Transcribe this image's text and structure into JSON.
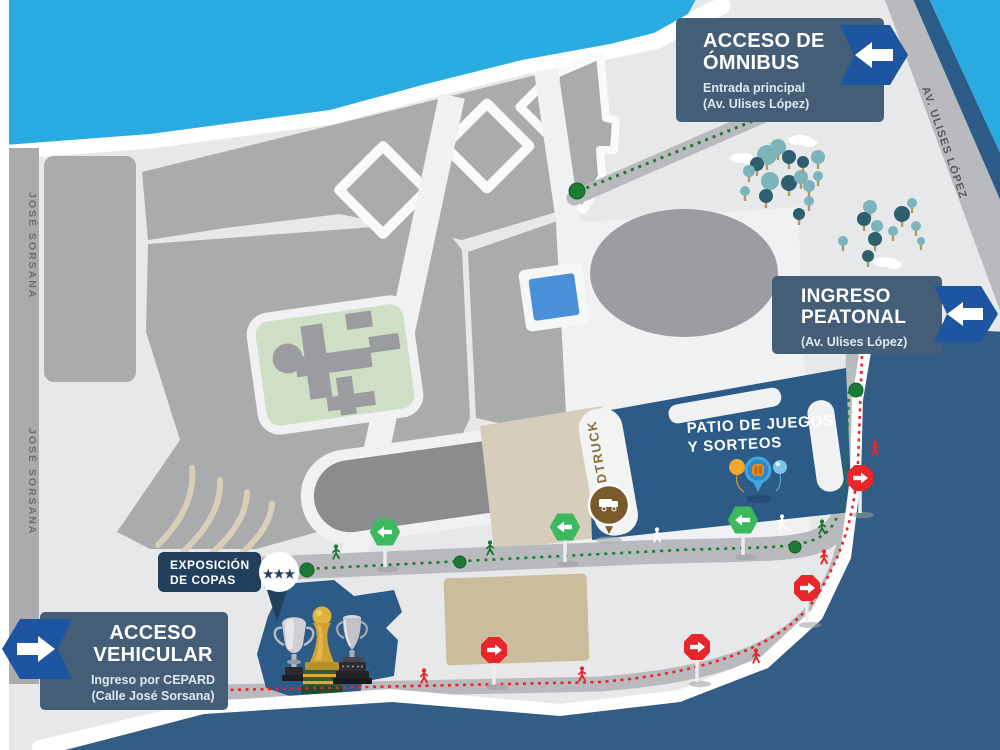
{
  "map": {
    "access_boxes": {
      "bus": {
        "title": [
          "ACCESO DE",
          "ÓMNIBUS"
        ],
        "subtitle": [
          "Entrada principal",
          "(Av. Ulises López)"
        ],
        "arrow_direction": "left"
      },
      "pedestrian": {
        "title": [
          "INGRESO",
          "PEATONAL"
        ],
        "subtitle": [
          "(Av. Ulises López)"
        ],
        "arrow_direction": "left"
      },
      "vehicular": {
        "title": [
          "ACCESO",
          "VEHICULAR"
        ],
        "subtitle": [
          "Ingreso por CEPARD",
          "(Calle José Sorsana)"
        ],
        "arrow_direction": "right"
      }
    },
    "areas": {
      "patio": [
        "PATIO DE JUEGOS",
        "Y SORTEOS"
      ],
      "foodtruck": "FOODTRUCK",
      "trophy_exhibit": [
        "EXPOSICIÓN",
        "DE COPAS"
      ],
      "trophy_stars": "★★★"
    },
    "streets": {
      "left": "JOSÉ SORSANA",
      "right": "AV. ULISES LÓPEZ"
    },
    "routes": {
      "bus": {
        "color": "#1e7a34",
        "style": "dashed"
      },
      "pedestrian": {
        "color": "#1e7a34",
        "style": "dashed"
      },
      "vehicular": {
        "color": "#e8252a",
        "style": "dashed"
      }
    },
    "icons": {
      "bus_badge": "left-arrow-icon",
      "pedestrian_badge": "left-arrow-icon",
      "vehicular_badge": "right-arrow-icon",
      "green_sign": "green-left-arrow-sign-icon",
      "red_sign": "red-right-arrow-sign-icon",
      "walking_person": "walking-person-icon",
      "tree": "tree-icon",
      "cloud": "cloud-icon",
      "balloons": "balloons-icon",
      "game_pin": "raffle-pin-icon",
      "foodtruck": "foodtruck-icon",
      "trophies": "trophy-icons",
      "stars": "three-stars-icon"
    },
    "colors": {
      "water_light": "#29abe2",
      "water_dark": "#335d85",
      "land": "#e7e8e9",
      "parcel": "#a9abad",
      "road": "#b9babd",
      "panel": "#455e77",
      "badge_blue": "#1e55a0",
      "patio_blue": "#2d5b88",
      "route_green": "#1e7a34",
      "route_red": "#e8252a",
      "sign_green": "#3cb95e",
      "green_area": "#cfdfc5",
      "sand": "#cbbd9c",
      "tree_teal": "#7cb4bc",
      "tree_dark": "#2d5f6e",
      "foodtruck_brown": "#7a5a2b",
      "bubble_navy": "#20405c",
      "pool": "#4a90d9"
    }
  }
}
